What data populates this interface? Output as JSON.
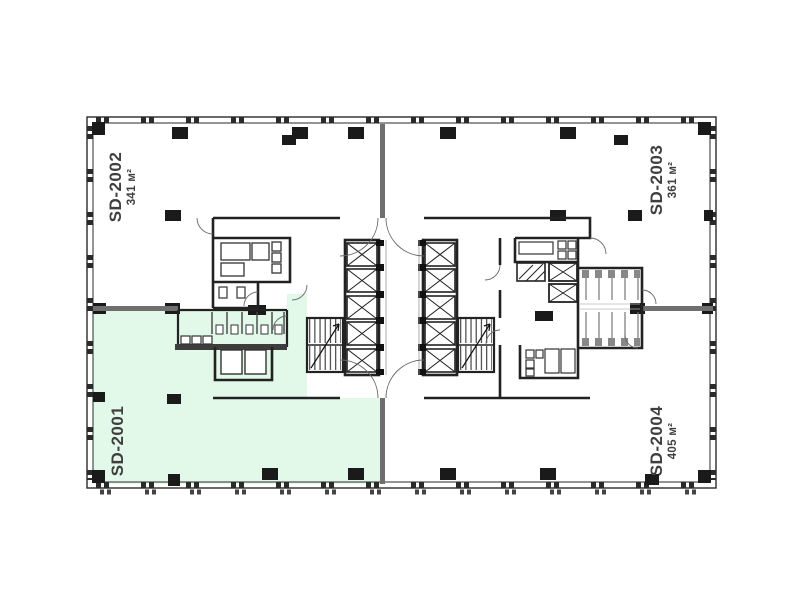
{
  "floor_plan": {
    "type": "office-floor-plan",
    "units": [
      {
        "id": "SD-2001",
        "area": "",
        "highlighted": true
      },
      {
        "id": "SD-2002",
        "area": "341 м²",
        "highlighted": false
      },
      {
        "id": "SD-2003",
        "area": "361 м²",
        "highlighted": false
      },
      {
        "id": "SD-2004",
        "area": "405 м²",
        "highlighted": false
      }
    ],
    "colors": {
      "highlight": "#e2f8e8",
      "walls": "#2a2a2a",
      "light_walls": "#777777",
      "text": "#3f3f3f"
    }
  }
}
